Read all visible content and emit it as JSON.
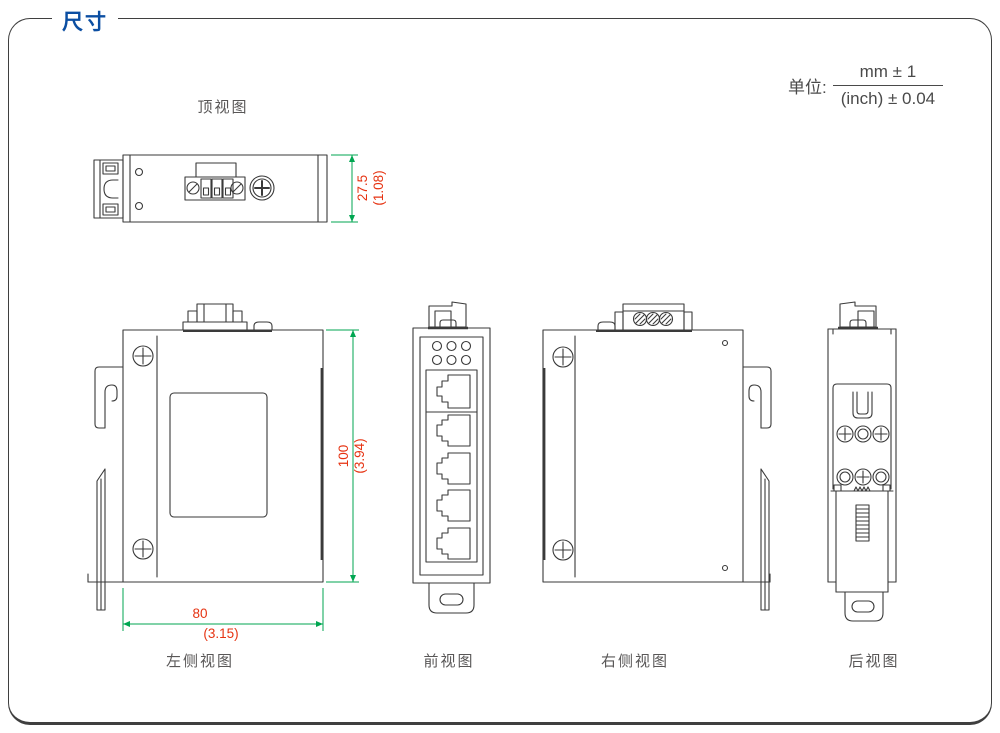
{
  "header": {
    "section_title": "尺寸",
    "unit_label": "单位:",
    "unit_numerator": "mm ± 1",
    "unit_denominator": "(inch) ± 0.04"
  },
  "views": {
    "top": {
      "label": "顶视图"
    },
    "left_side": {
      "label": "左侧视图"
    },
    "front": {
      "label": "前视图"
    },
    "right_side": {
      "label": "右侧视图"
    },
    "rear": {
      "label": "后视图"
    }
  },
  "dimensions": {
    "depth": {
      "mm": "27.5",
      "inch": "(1.08)"
    },
    "height": {
      "mm": "100",
      "inch": "(3.94)"
    },
    "width": {
      "mm": "80",
      "inch": "(3.15)"
    }
  },
  "colors": {
    "title_blue": "#0b4ea2",
    "dimension_text_red": "#e63312",
    "dimension_line_green": "#00a651",
    "drawing_line_gray": "#3a3a3a",
    "label_gray": "#595757"
  }
}
